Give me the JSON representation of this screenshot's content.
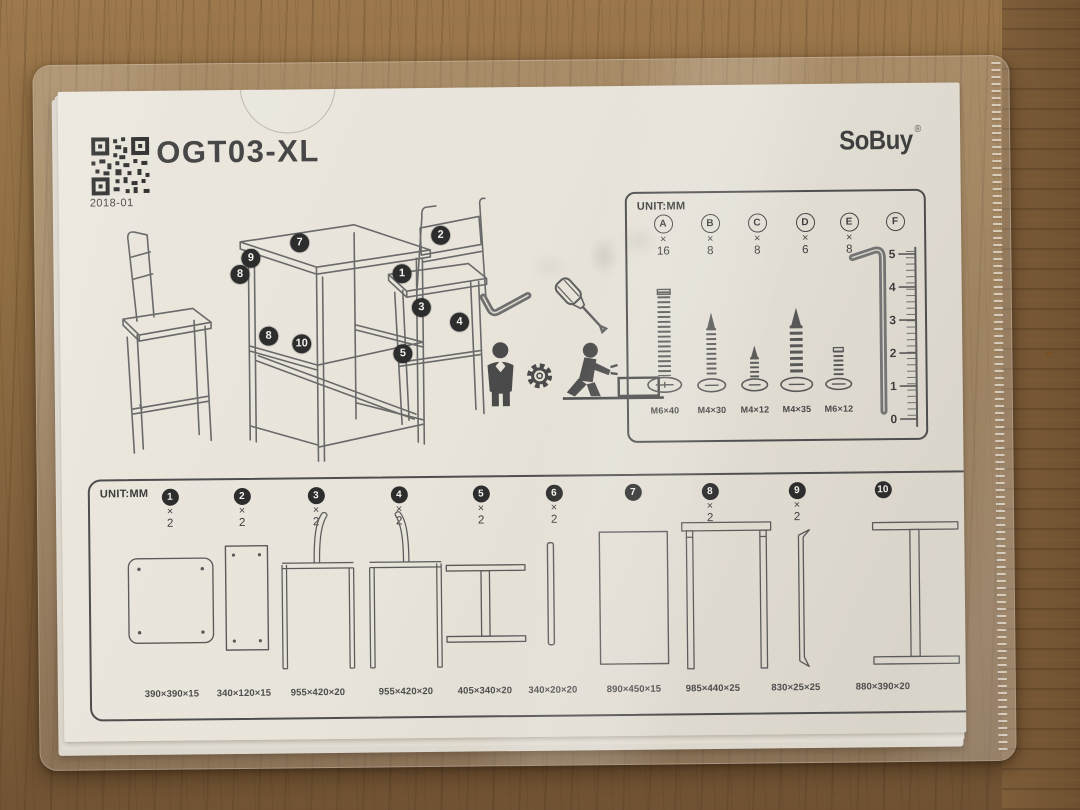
{
  "document": {
    "model": "OGT03-XL",
    "date_code": "2018-01",
    "brand": "SoBuy",
    "brand_mark": "®"
  },
  "hardware_box": {
    "unit_label": "UNIT:MM",
    "items": [
      {
        "letter": "A",
        "times": "×",
        "qty": "16",
        "size": "M6×40"
      },
      {
        "letter": "B",
        "times": "×",
        "qty": "8",
        "size": "M4×30"
      },
      {
        "letter": "C",
        "times": "×",
        "qty": "8",
        "size": "M4×12"
      },
      {
        "letter": "D",
        "times": "×",
        "qty": "6",
        "size": "M4×35"
      },
      {
        "letter": "E",
        "times": "×",
        "qty": "8",
        "size": "M6×12"
      },
      {
        "letter": "F",
        "times": "",
        "qty": "",
        "size": ""
      }
    ],
    "ruler_ticks": [
      "5",
      "4",
      "3",
      "2",
      "1",
      "0"
    ]
  },
  "assembly_diagram": {
    "callouts": [
      "7",
      "9",
      "8",
      "2",
      "1",
      "3",
      "4",
      "8",
      "10",
      "5"
    ]
  },
  "parts_panel": {
    "unit_label": "UNIT:MM",
    "parts": [
      {
        "num": "1",
        "times": "×",
        "qty": "2",
        "dim": "390×390×15"
      },
      {
        "num": "2",
        "times": "×",
        "qty": "2",
        "dim": "340×120×15"
      },
      {
        "num": "3",
        "times": "×",
        "qty": "2",
        "dim": "955×420×20"
      },
      {
        "num": "4",
        "times": "×",
        "qty": "2",
        "dim": "955×420×20"
      },
      {
        "num": "5",
        "times": "×",
        "qty": "2",
        "dim": "405×340×20"
      },
      {
        "num": "6",
        "times": "×",
        "qty": "2",
        "dim": "340×20×20"
      },
      {
        "num": "7",
        "times": "",
        "qty": "",
        "dim": "890×450×15"
      },
      {
        "num": "8",
        "times": "×",
        "qty": "2",
        "dim": "985×440×25"
      },
      {
        "num": "9",
        "times": "×",
        "qty": "2",
        "dim": "830×25×25"
      },
      {
        "num": "10",
        "times": "",
        "qty": "",
        "dim": "880×390×20"
      }
    ]
  },
  "colors": {
    "ink": "#3d3d3d",
    "paper": "#e8e4da",
    "wood": "#85643e",
    "badge": "#2d2d2d"
  }
}
